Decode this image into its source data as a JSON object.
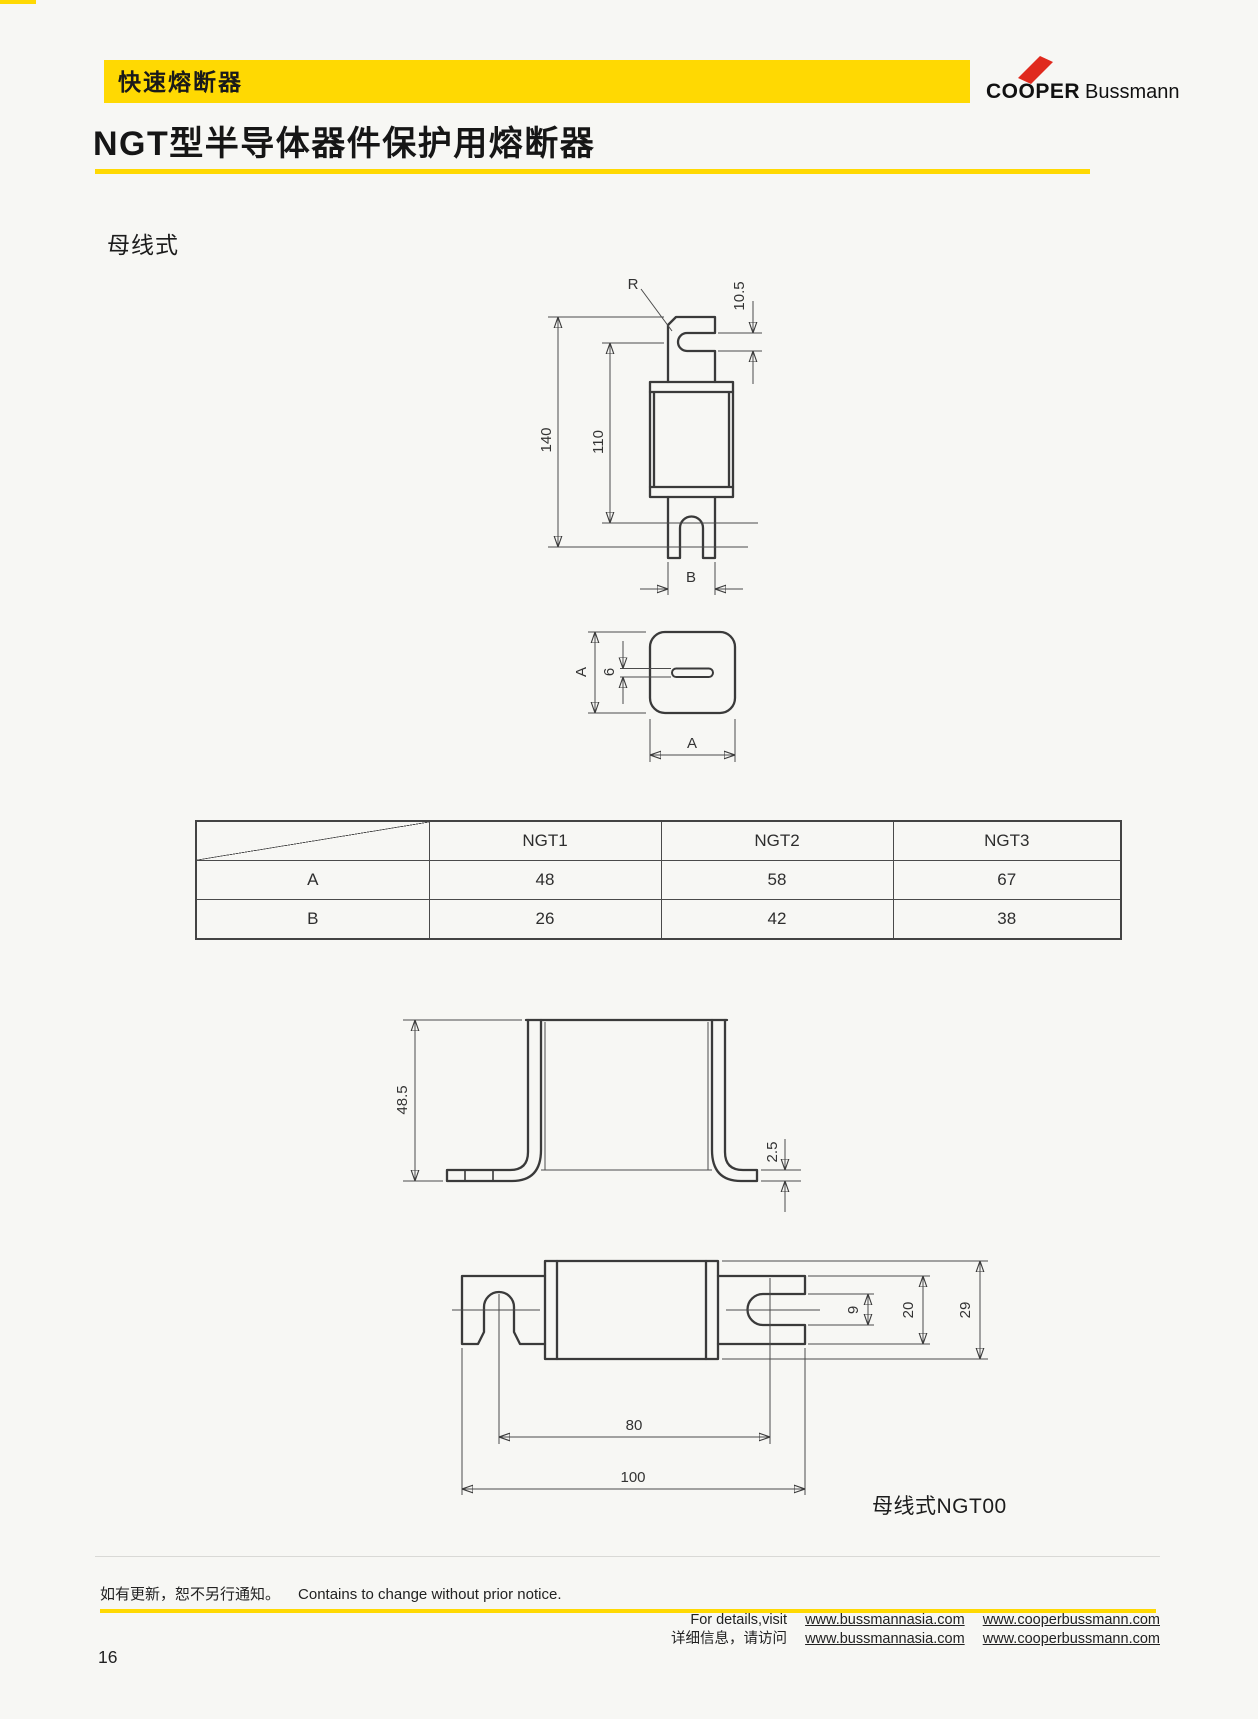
{
  "page": {
    "number": "16",
    "accent": "#ffd902",
    "logo_red": "#e02a1e"
  },
  "header": {
    "banner": "快速熔断器",
    "logo": {
      "cooper": "COOPER",
      "bussmann": "Bussmann"
    },
    "title": "NGT型半导体器件保护用熔断器"
  },
  "section": {
    "label": "母线式"
  },
  "drawing_front": {
    "dims": {
      "radius": "R",
      "slot": "10.5",
      "overall": "140",
      "body": "110",
      "blade_width": "B"
    }
  },
  "drawing_top": {
    "dims": {
      "height": "A",
      "slot": "6",
      "width": "A"
    }
  },
  "table": {
    "headers": [
      "NGT1",
      "NGT2",
      "NGT3"
    ],
    "rows": [
      {
        "label": "A",
        "values": [
          "48",
          "58",
          "67"
        ]
      },
      {
        "label": "B",
        "values": [
          "26",
          "42",
          "38"
        ]
      }
    ]
  },
  "drawing_bracket": {
    "dims": {
      "height": "48.5",
      "foot": "2.5"
    }
  },
  "drawing_side": {
    "dims": {
      "slot": "9",
      "blade": "20",
      "body": "29",
      "centers": "80",
      "overall": "100"
    },
    "caption": "母线式NGT00"
  },
  "footer": {
    "notice_cn": "如有更新，恕不另行通知。",
    "notice_en": "Contains to change without prior notice.",
    "line1_prefix": "For details,visit",
    "line2_prefix": "详细信息，请访问",
    "url1": "www.bussmannasia.com",
    "url2": "www.cooperbussmann.com"
  }
}
